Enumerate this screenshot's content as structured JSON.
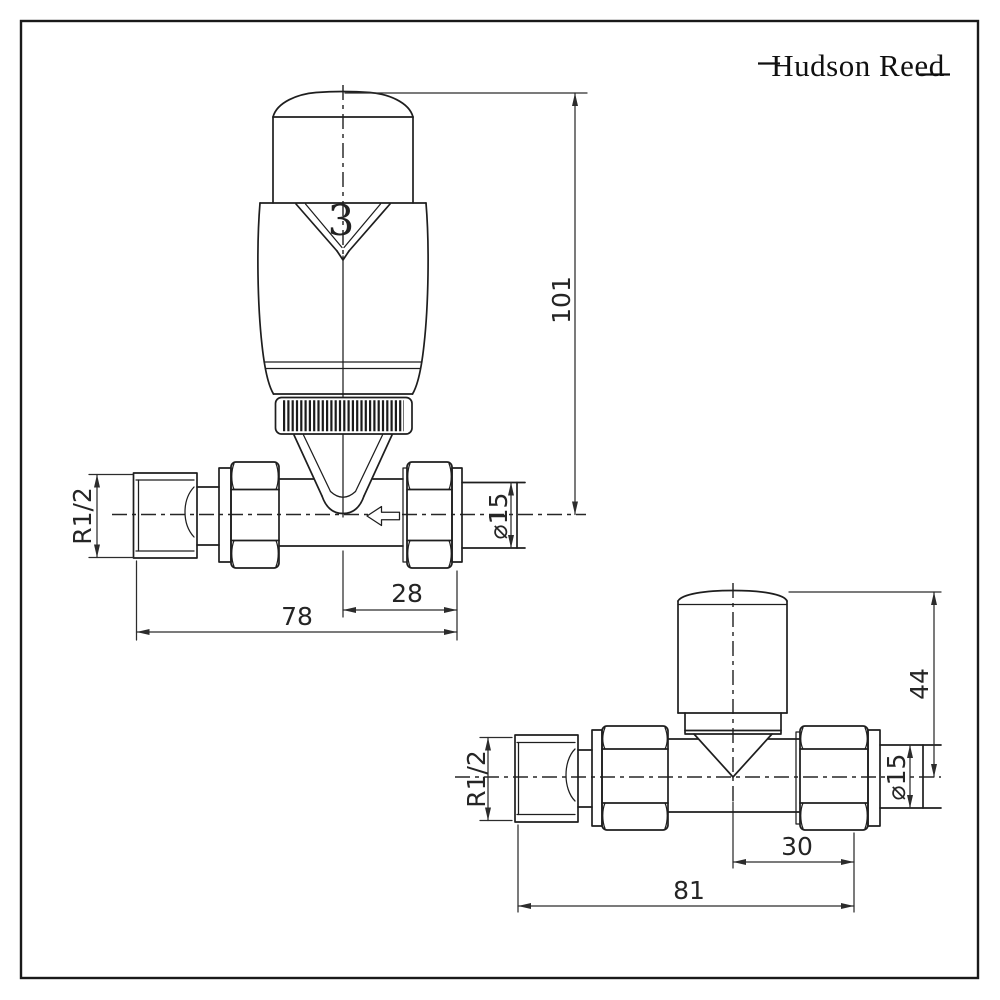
{
  "logo": {
    "text": "Hudson Reed"
  },
  "colors": {
    "line": "#1e1e1e",
    "dimension": "#2c2c2c",
    "background": "#ffffff"
  },
  "trv_drawing": {
    "description": "thermostatic radiator valve, straight, front view",
    "setting_number": "3",
    "dims": {
      "overall_height": "101",
      "thread": "R1/2",
      "pipe_diameter": "⌀15",
      "center_to_pipe_end": "28",
      "body_length": "78"
    }
  },
  "manual_drawing": {
    "description": "manual radiator valve, straight, front view",
    "dims": {
      "height_to_center": "44",
      "thread": "R1/2",
      "pipe_diameter": "⌀15",
      "center_to_pipe_end": "30",
      "body_length": "81"
    }
  }
}
